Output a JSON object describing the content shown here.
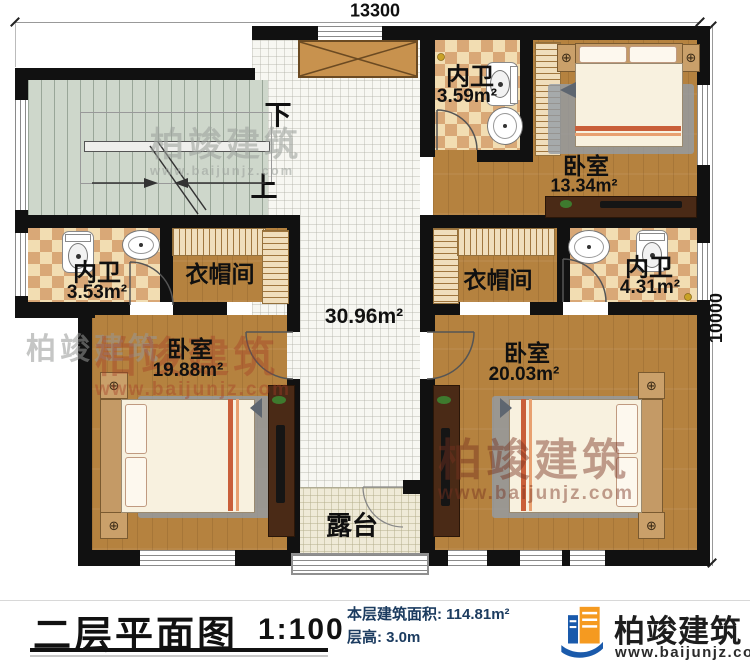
{
  "dimensions": {
    "top": "13300",
    "right": "10000"
  },
  "stairs": {
    "down": "下",
    "up": "上"
  },
  "rooms": {
    "hall": {
      "area": "30.96m²"
    },
    "bath_top": {
      "name": "内卫",
      "area": "3.59m²"
    },
    "bedroom_top_right": {
      "name": "卧室",
      "area": "13.34m²"
    },
    "bath_left": {
      "name": "内卫",
      "area": "3.53m²"
    },
    "closet_left": {
      "name": "衣帽间"
    },
    "closet_right": {
      "name": "衣帽间"
    },
    "bath_right": {
      "name": "内卫",
      "area": "4.31m²"
    },
    "bedroom_bottom_left": {
      "name": "卧室",
      "area": "19.88m²"
    },
    "bedroom_bottom_right": {
      "name": "卧室",
      "area": "20.03m²"
    },
    "terrace": {
      "name": "露台"
    }
  },
  "footer": {
    "title": "二层平面图",
    "scale": "1:100",
    "floor_area": "本层建筑面积: 114.81m²",
    "floor_height": "层高: 3.0m",
    "brand": "柏竣建筑",
    "website": "www.baijunjz.com"
  },
  "watermarks": {
    "brand": "柏竣建筑",
    "website": "www.baijunjz.com"
  },
  "icons": {
    "flower": "⊕"
  },
  "colors": {
    "wall": "#111111",
    "wood": "#b5823f",
    "tile_light": "#f2ddb2",
    "tile_dark": "#d9a877",
    "stair": "#ced7cb",
    "navy": "#1c3c60",
    "brand_blue": "#1a5aab",
    "brand_orange": "#f59a20"
  }
}
